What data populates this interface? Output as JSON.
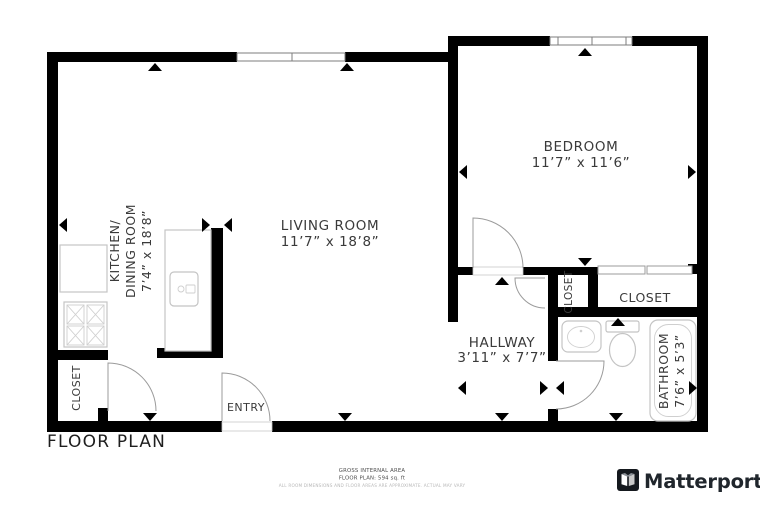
{
  "title": "FLOOR PLAN",
  "rooms": {
    "living_room": {
      "name": "LIVING ROOM",
      "dims": "11’7” x 18’8”"
    },
    "bedroom": {
      "name": "BEDROOM",
      "dims": "11’7” x 11’6”"
    },
    "kitchen": {
      "name_line1": "KITCHEN/",
      "name_line2": "DINING ROOM",
      "dims": "7’4” x 18’8”"
    },
    "hallway": {
      "name": "HALLWAY",
      "dims": "3’11” x 7’7”"
    },
    "bathroom": {
      "name": "BATHROOM",
      "dims": "7’6” x 5’3”"
    },
    "bedroom_closet": {
      "name": "CLOSET"
    },
    "hall_closet": {
      "name": "CLOSET"
    },
    "entry_closet": {
      "name": "CLOSET"
    },
    "entry": {
      "name": "ENTRY"
    }
  },
  "footer": {
    "area_label": "GROSS INTERNAL AREA",
    "area_value": "FLOOR PLAN: 594 sq. ft",
    "disclaimer": "ALL ROOM DIMENSIONS AND FLOOR AREAS ARE APPROXIMATE. ACTUAL MAY VARY",
    "brand": "Matterport"
  },
  "colors": {
    "wall": "#000000",
    "label_text": "#3a3a3a",
    "fixture_stroke": "#c4c4c4",
    "door_stroke": "#9b9b9b",
    "footer_text": "#4d4d4d",
    "disclaimer_text": "#b8b8b8",
    "brand_text": "#20262c"
  },
  "markers": [
    {
      "x": 155,
      "y": 63,
      "dir": "up"
    },
    {
      "x": 347,
      "y": 63,
      "dir": "up"
    },
    {
      "x": 585,
      "y": 48,
      "dir": "up"
    },
    {
      "x": 59,
      "y": 225,
      "dir": "left"
    },
    {
      "x": 459,
      "y": 172,
      "dir": "left"
    },
    {
      "x": 696,
      "y": 172,
      "dir": "right"
    },
    {
      "x": 210,
      "y": 225,
      "dir": "right"
    },
    {
      "x": 224,
      "y": 225,
      "dir": "left"
    },
    {
      "x": 585,
      "y": 266,
      "dir": "down"
    },
    {
      "x": 502,
      "y": 277,
      "dir": "up"
    },
    {
      "x": 458,
      "y": 388,
      "dir": "left"
    },
    {
      "x": 548,
      "y": 388,
      "dir": "right"
    },
    {
      "x": 556,
      "y": 388,
      "dir": "left"
    },
    {
      "x": 697,
      "y": 388,
      "dir": "right"
    },
    {
      "x": 618,
      "y": 318,
      "dir": "up"
    },
    {
      "x": 616,
      "y": 421,
      "dir": "down"
    },
    {
      "x": 502,
      "y": 421,
      "dir": "down"
    },
    {
      "x": 345,
      "y": 421,
      "dir": "down"
    },
    {
      "x": 150,
      "y": 421,
      "dir": "down"
    }
  ]
}
